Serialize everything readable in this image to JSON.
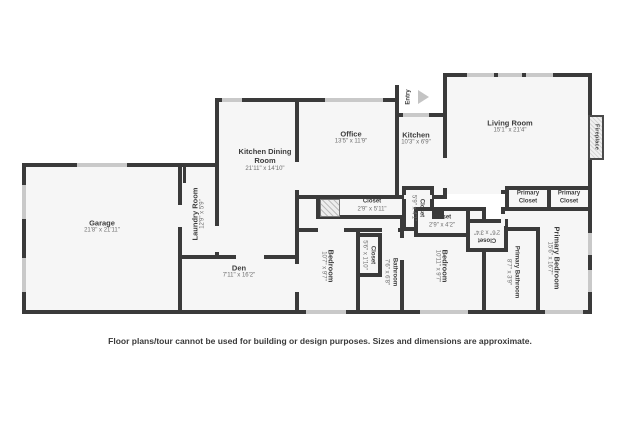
{
  "colors": {
    "wall": "#3a3a3a",
    "floor": "#f6f6f6",
    "window": "#c9c9c9",
    "background": "#ffffff"
  },
  "rooms": {
    "garage": {
      "name": "Garage",
      "dims": "21'8\" x 21'11\""
    },
    "laundry": {
      "name": "Laundry Room",
      "dims": "12'9\" x 5'9\""
    },
    "kitchenDining": {
      "name": "Kitchen Dining Room",
      "dims": "21'11\" x 14'10\""
    },
    "office": {
      "name": "Office",
      "dims": "13'5\" x 11'9\""
    },
    "kitchen": {
      "name": "Kitchen",
      "dims": "10'3\" x 6'9\""
    },
    "entry": {
      "name": "Entry"
    },
    "living": {
      "name": "Living Room",
      "dims": "15'1\" x 21'4\""
    },
    "fireplace": {
      "name": "Fireplace"
    },
    "primaryCloset1": {
      "name": "Primary Closet"
    },
    "primaryCloset2": {
      "name": "Primary Closet"
    },
    "primaryBedroom": {
      "name": "Primary Bedroom",
      "dims": "15'6\" x 16'7\""
    },
    "primaryBathroom": {
      "name": "Primary Bathroom",
      "dims": "8'7\" x 3'9\""
    },
    "closetLinen": {
      "name": "Closet",
      "dims": "2'6\" x 3'4\""
    },
    "closetBedroom2": {
      "name": "Closet",
      "dims": "2'9\" x 4'2\""
    },
    "bedroom2": {
      "name": "Bedroom",
      "dims": "10'11\" x 9'7\""
    },
    "closetHall2": {
      "name": "Closet",
      "dims": "5'9\" x 4'1\""
    },
    "closetHall1": {
      "name": "Closet",
      "dims": "2'9\" x 5'11\""
    },
    "bathroom": {
      "name": "Bathroom",
      "dims": "7'6\" x 6'8\""
    },
    "closetBedroom1": {
      "name": "Closet",
      "dims": "5'6\" x 1'10\""
    },
    "bedroom1": {
      "name": "Bedroom",
      "dims": "10'7\" x 9'7\""
    },
    "den": {
      "name": "Den",
      "dims": "7'11\" x 16'2\""
    }
  },
  "disclaimer": "Floor plans/tour cannot be used for building or design purposes. Sizes and dimensions are approximate."
}
